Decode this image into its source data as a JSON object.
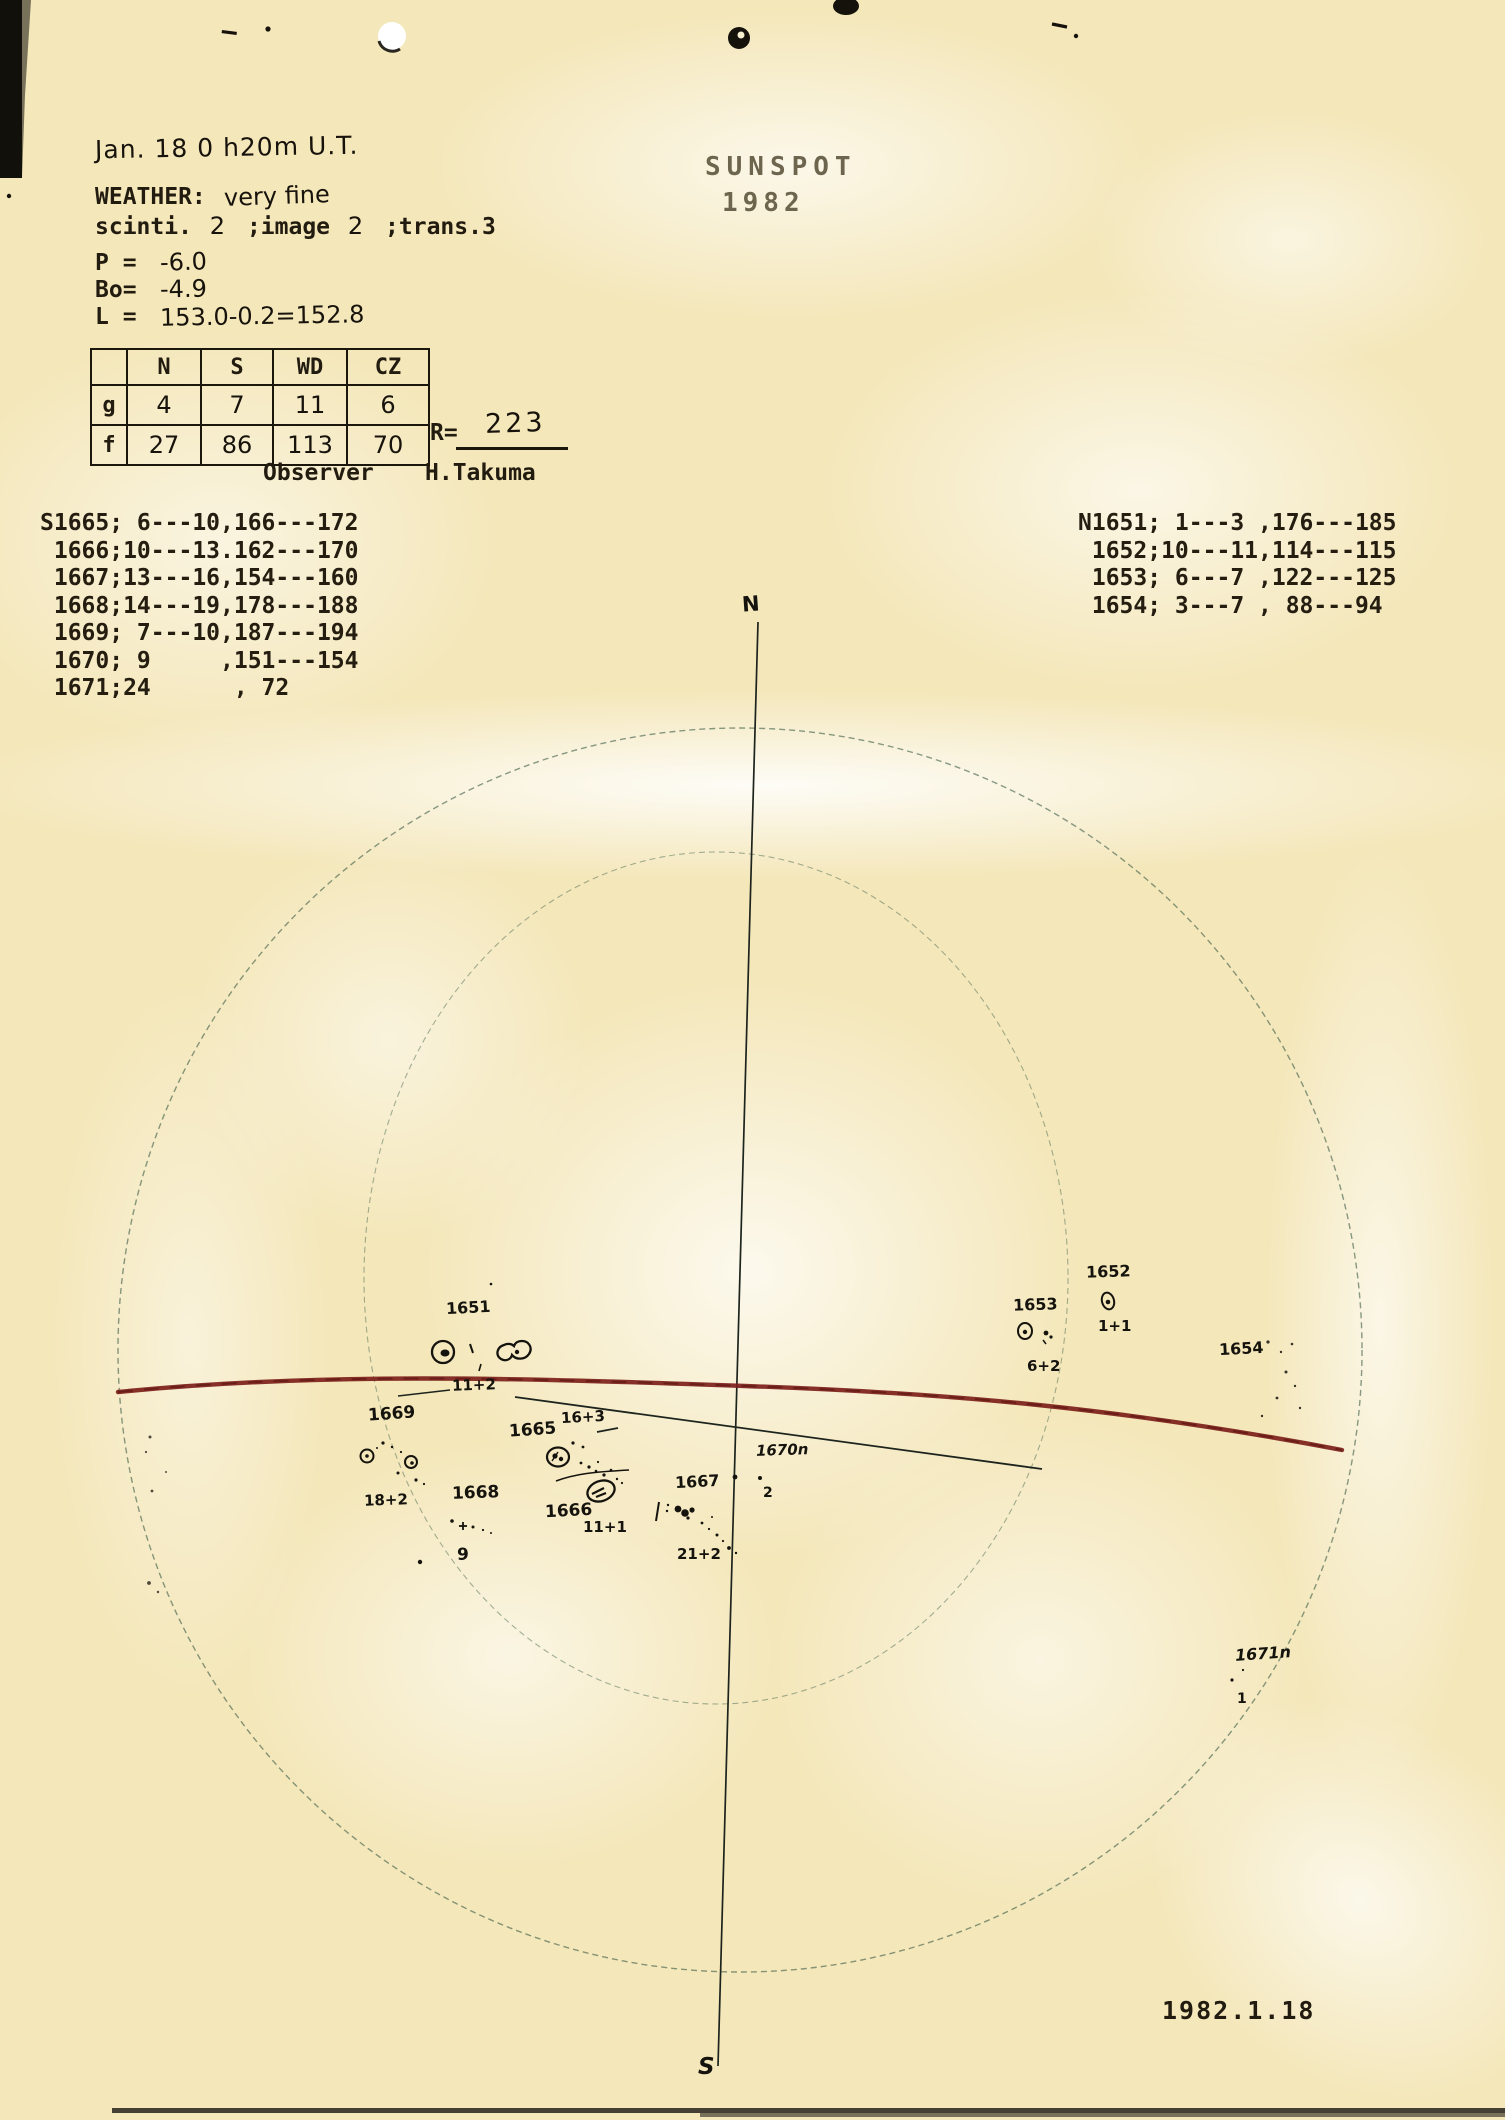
{
  "page": {
    "paper_color": "#f4e7ba",
    "ink_color": "#221c10",
    "red_line_color": "#7c1f1a",
    "circle_color": "#3a5a44"
  },
  "header": {
    "date_line": "Jan. 18   0 h20m  U.T.",
    "weather_label": "WEATHER:",
    "weather_value": "very fine",
    "seeing": {
      "scinti_label": "scinti.",
      "scinti_value": "2",
      "image_label": ";image",
      "image_value": "2",
      "trans_label": ";trans.3"
    },
    "p_label": "P =",
    "p_value": "-6.0",
    "bo_label": "Bo=",
    "bo_value": "-4.9",
    "l_label": "L =",
    "l_value": "153.0-0.2=152.8"
  },
  "title": {
    "line1": "SUNSPOT",
    "line2": "1982"
  },
  "counts_table": {
    "col_headers": [
      "N",
      "S",
      "WD",
      "CZ"
    ],
    "rows": [
      {
        "label": "g",
        "values": [
          "4",
          "7",
          "11",
          "6"
        ]
      },
      {
        "label": "f",
        "values": [
          "27",
          "86",
          "113",
          "70"
        ]
      }
    ]
  },
  "relative_number": {
    "label": "R=",
    "value": "223"
  },
  "observer": {
    "label": "Observer",
    "name": "H.Takuma"
  },
  "south_groups": {
    "lines": [
      "S1665; 6---10,166---172",
      " 1666;10---13.162---170",
      " 1667;13---16,154---160",
      " 1668;14---19,178---188",
      " 1669; 7---10,187---194",
      " 1670; 9     ,151---154",
      " 1671;24      , 72"
    ]
  },
  "north_groups": {
    "lines": [
      "N1651; 1---3 ,176---185",
      " 1652;10---11,114---115",
      " 1653; 6---7 ,122---125",
      " 1654; 3---7 , 88---94"
    ]
  },
  "diagram": {
    "date_label": "1982.1.18",
    "labels": [
      {
        "text": "N"
      },
      {
        "text": "S"
      },
      {
        "text": "1651"
      },
      {
        "text": "11+2"
      },
      {
        "text": "1652"
      },
      {
        "text": "1+1"
      },
      {
        "text": "1653"
      },
      {
        "text": "6+2"
      },
      {
        "text": "1654"
      },
      {
        "text": "1669"
      },
      {
        "text": "18+2"
      },
      {
        "text": "1665"
      },
      {
        "text": "16+3"
      },
      {
        "text": "1666"
      },
      {
        "text": "11+1"
      },
      {
        "text": "1668"
      },
      {
        "text": "9"
      },
      {
        "text": "1667"
      },
      {
        "text": "21+2"
      },
      {
        "text": "1670n"
      },
      {
        "text": "2"
      },
      {
        "text": "1671n"
      },
      {
        "text": "1"
      }
    ]
  }
}
